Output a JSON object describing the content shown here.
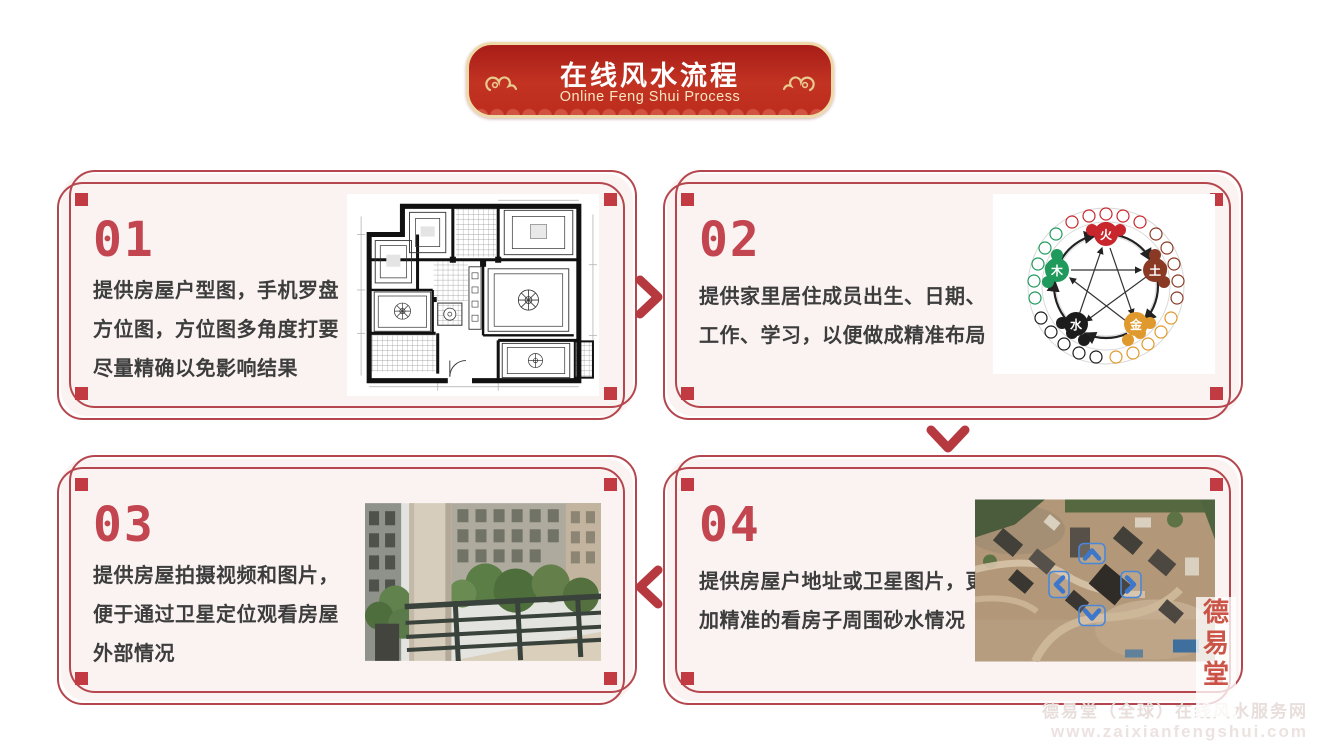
{
  "header": {
    "title": "在线风水流程",
    "subtitle": "Online Feng Shui Process"
  },
  "steps": [
    {
      "number": "01",
      "text_lines": [
        "提供房屋户型图，手机罗盘",
        "方位图，方位图多角度打要",
        "尽量精确以免影响结果"
      ],
      "image": "house-floor-plan"
    },
    {
      "number": "02",
      "text_lines": [
        "提供家里居住成员出生、日期、",
        "工作、学习，以便做成精准布局"
      ],
      "image": "five-elements-diagram"
    },
    {
      "number": "03",
      "text_lines": [
        "提供房屋拍摄视频和图片，",
        "便于通过卫星定位观看房屋",
        "外部情况"
      ],
      "image": "balcony-exterior-photo"
    },
    {
      "number": "04",
      "text_lines": [
        "提供房屋户地址或卫星图片，更",
        "加精准的看房子周围砂水情况"
      ],
      "image": "satellite-map-photo"
    }
  ],
  "five_elements": {
    "fire": {
      "label": "火",
      "color": "#c9252c"
    },
    "wood": {
      "label": "木",
      "color": "#1f9a5c"
    },
    "earth": {
      "label": "土",
      "color": "#8a3a24"
    },
    "water": {
      "label": "水",
      "color": "#1c1c1c"
    },
    "metal": {
      "label": "金",
      "color": "#e0992c"
    }
  },
  "seal_text": {
    "c1": "德",
    "c2": "易",
    "c3": "堂"
  },
  "watermark": {
    "site_name": "德易堂（全球）在线风水服务网",
    "site_url": "www.zaixianfengshui.com"
  },
  "colors": {
    "banner_red": "#bf2b1d",
    "banner_border": "#eed9a9",
    "box_border": "#b5464e",
    "box_fill": "#faf3f1",
    "accent_red": "#c2454f",
    "body_text": "#3d3d3d",
    "arrow_red": "#b6393f"
  }
}
